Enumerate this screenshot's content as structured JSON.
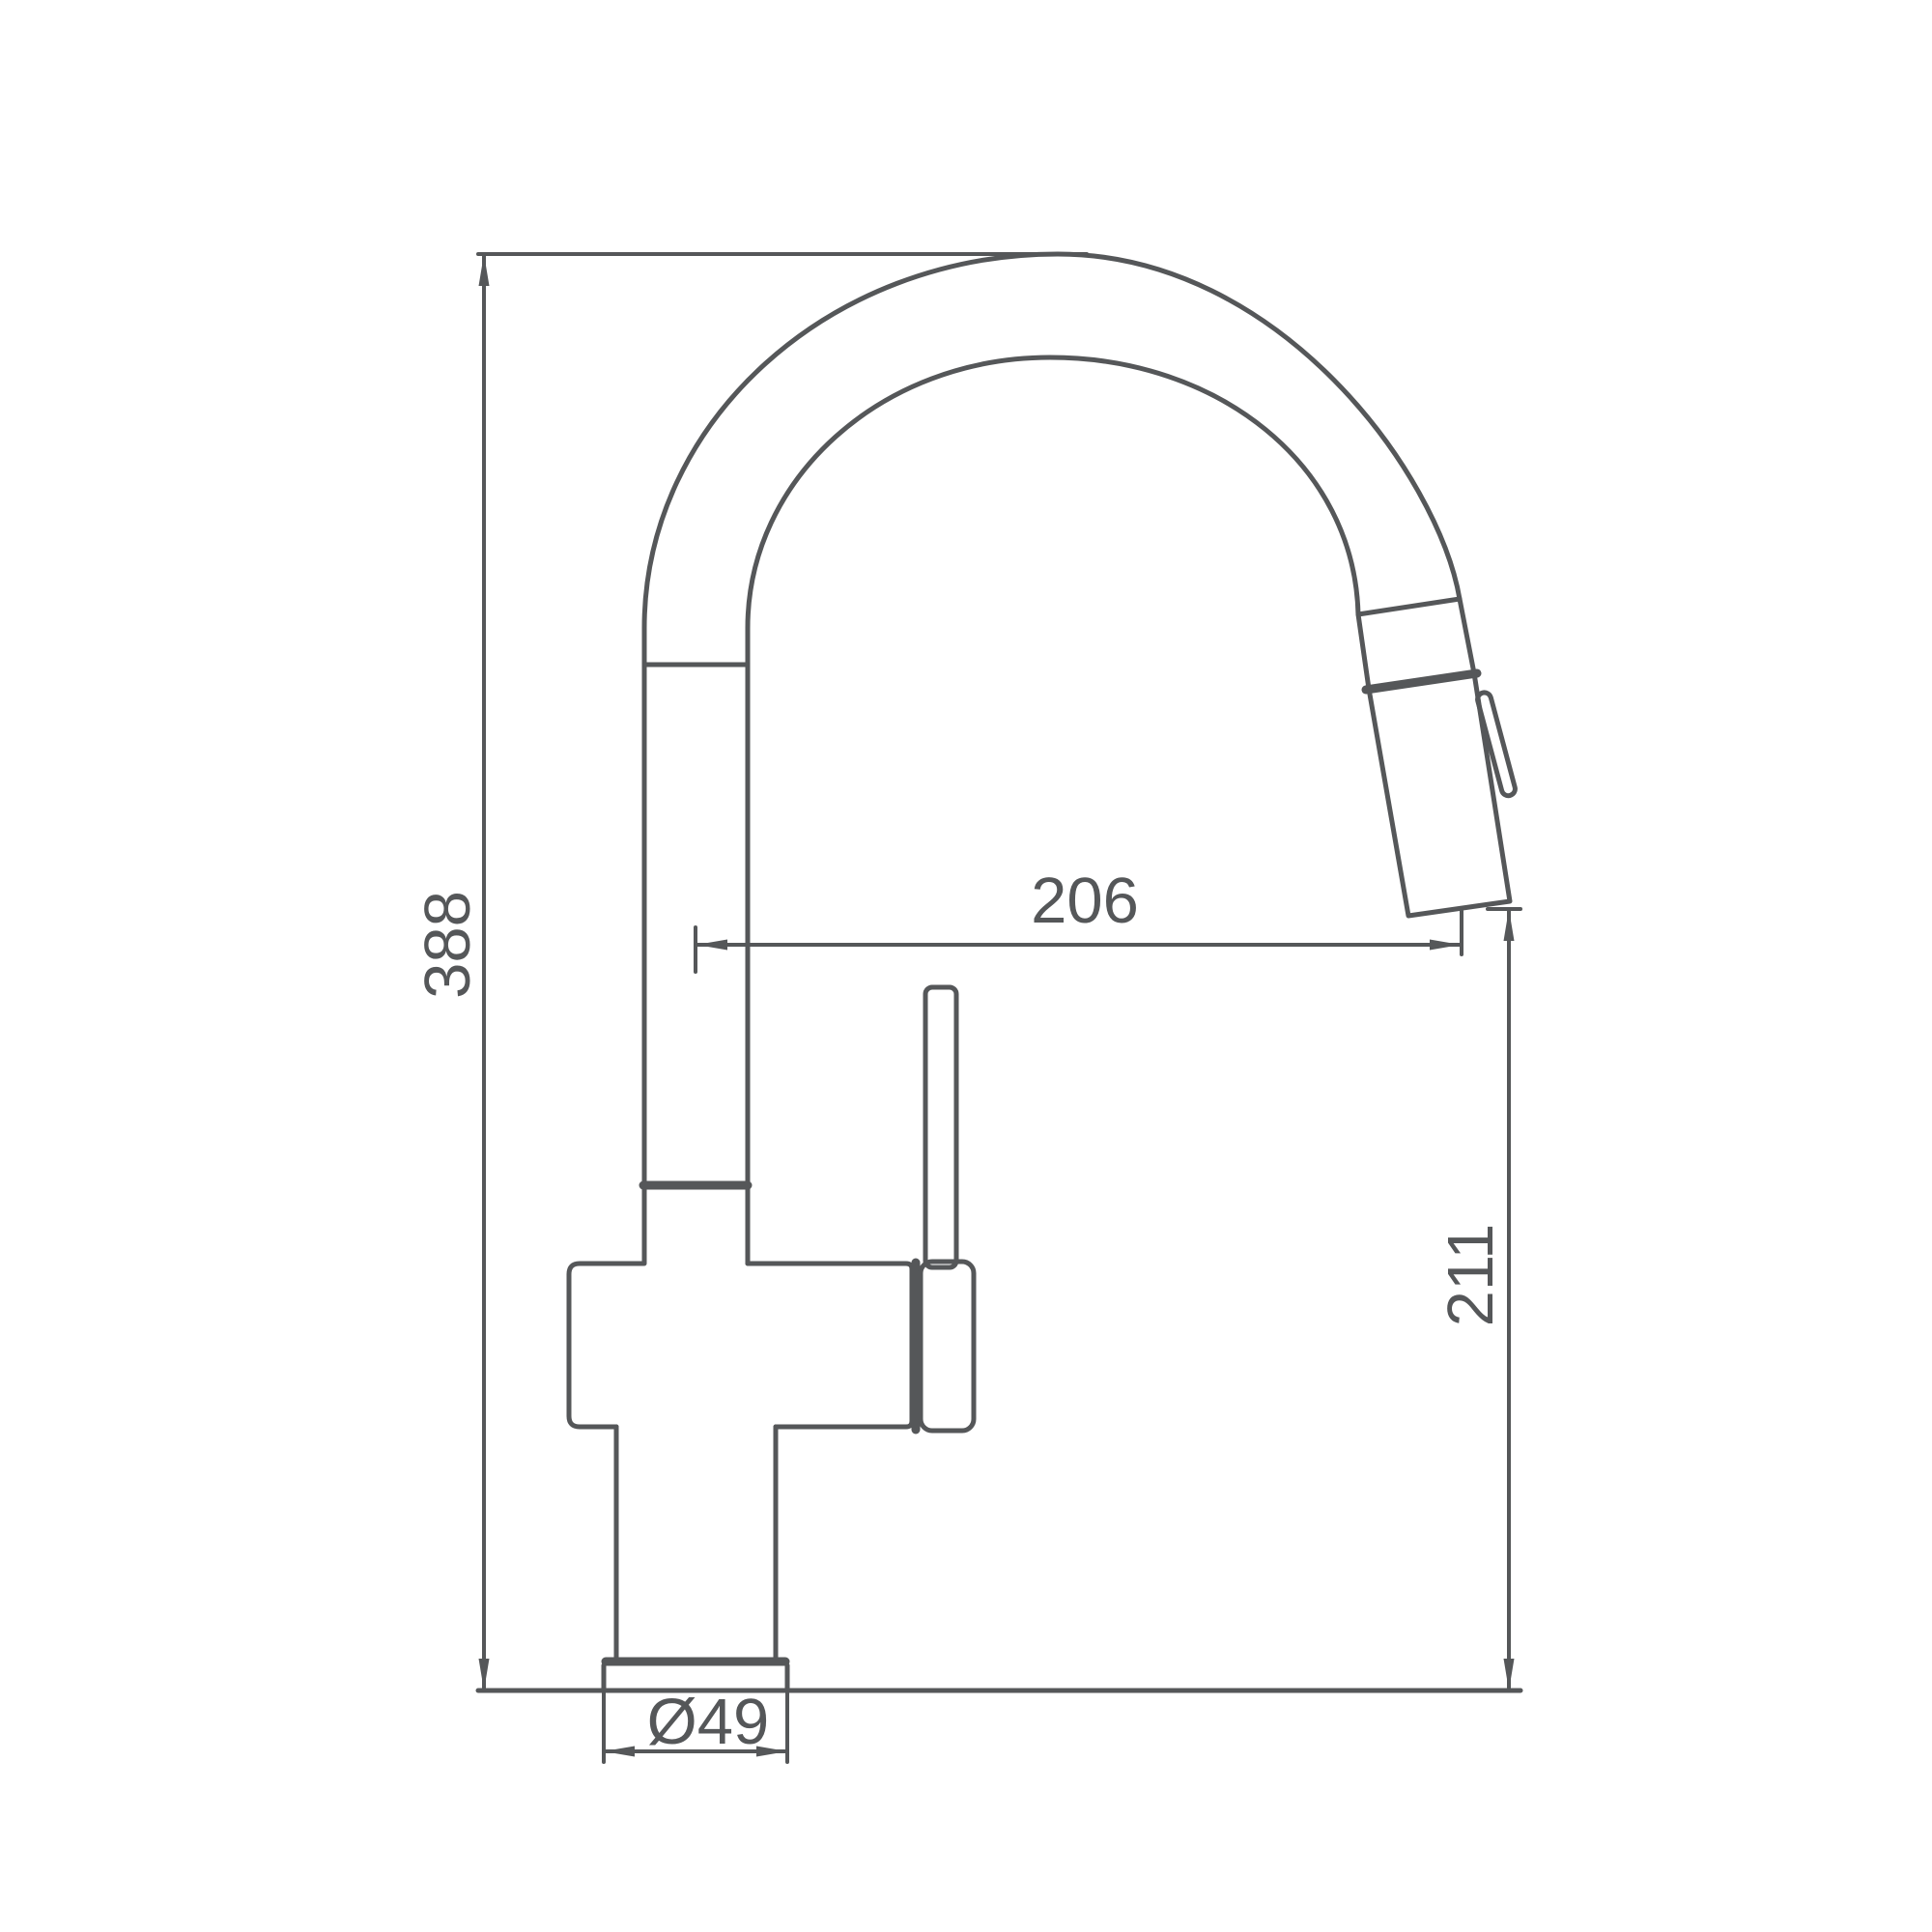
{
  "drawing": {
    "title": "kitchen-faucet-dimension-drawing",
    "units": "mm",
    "colors": {
      "line": "#555759",
      "background": "#ffffff"
    },
    "dimensions": {
      "overall_height": "388",
      "spout_reach": "206",
      "outlet_height": "211",
      "base_diameter": "Ø49"
    }
  }
}
